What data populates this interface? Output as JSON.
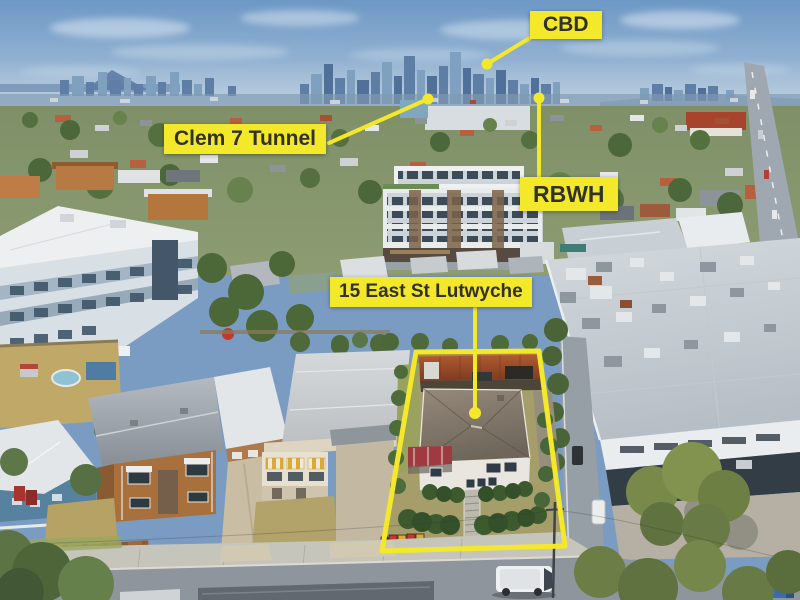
{
  "meta": {
    "image_type": "aerial-drone-photo-with-callouts",
    "subject": "15 East St Lutwyche"
  },
  "theme": {
    "colors": {
      "accent": "#f4e82a",
      "label-text": "#33322a"
    }
  },
  "labels": {
    "cbd": "CBD",
    "clem7": "Clem 7 Tunnel",
    "rbwh": "RBWH",
    "property": "15 East St Lutwyche"
  },
  "annotations": {
    "boundary_points": "416,352 539,351 565,546 382,551",
    "leaders": {
      "cbd": "533,36 487,64",
      "clem7": "329,143 428,99",
      "rbwh": "539,177 539,98",
      "property": "475,309 475,413"
    },
    "dots": {
      "cbd": {
        "cx": "487",
        "cy": "64",
        "r": "5.5"
      },
      "clem7": {
        "cx": "428",
        "cy": "99",
        "r": "5.5"
      },
      "rbwh": {
        "cx": "539",
        "cy": "98",
        "r": "5.5"
      },
      "property": {
        "cx": "475",
        "cy": "413",
        "r": "6"
      }
    }
  }
}
